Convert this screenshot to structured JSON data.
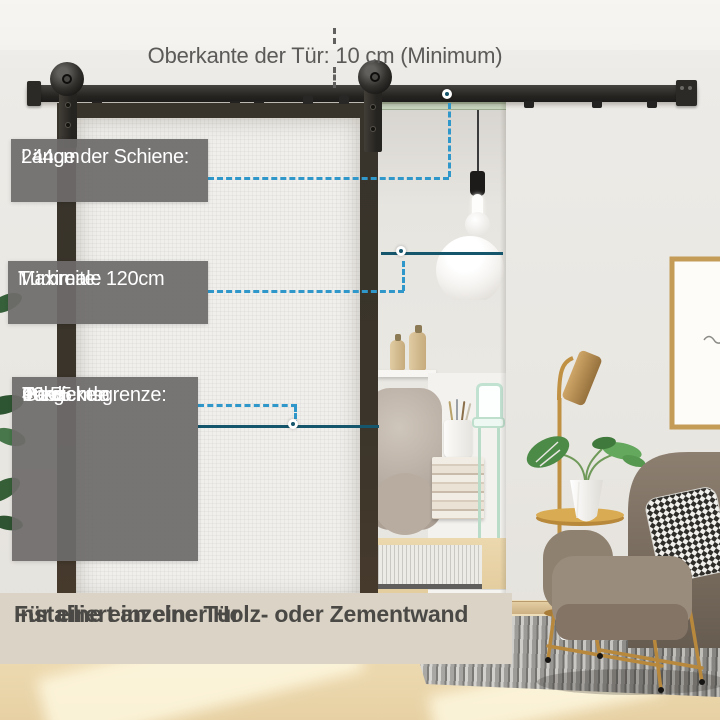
{
  "top_note": {
    "text": "Oberkante der Tür: 10 cm (Minimum)"
  },
  "boxes": {
    "rail_length": {
      "line1": "Länge der Schiene:",
      "line2": "244cm"
    },
    "door_width": {
      "line1": "Maximale",
      "line2": "Türbreite: 120cm"
    },
    "weight_limit": {
      "line1": "Gewichtsgrenze:",
      "line2": "90kg"
    },
    "door_thickness": {
      "line1": "Passende",
      "line2": "Türdicke:",
      "line3": "40-55 mm"
    }
  },
  "caption": {
    "line1": "Für eine einzelne Tür",
    "line2": "Installiert an einer Holz- oder Zementwand"
  },
  "colors": {
    "dashed_line": "#2f97c9",
    "solid_line": "#15566c",
    "label_box": "rgba(110,108,106,0.93)",
    "caption_band": "#dbd3c5"
  }
}
